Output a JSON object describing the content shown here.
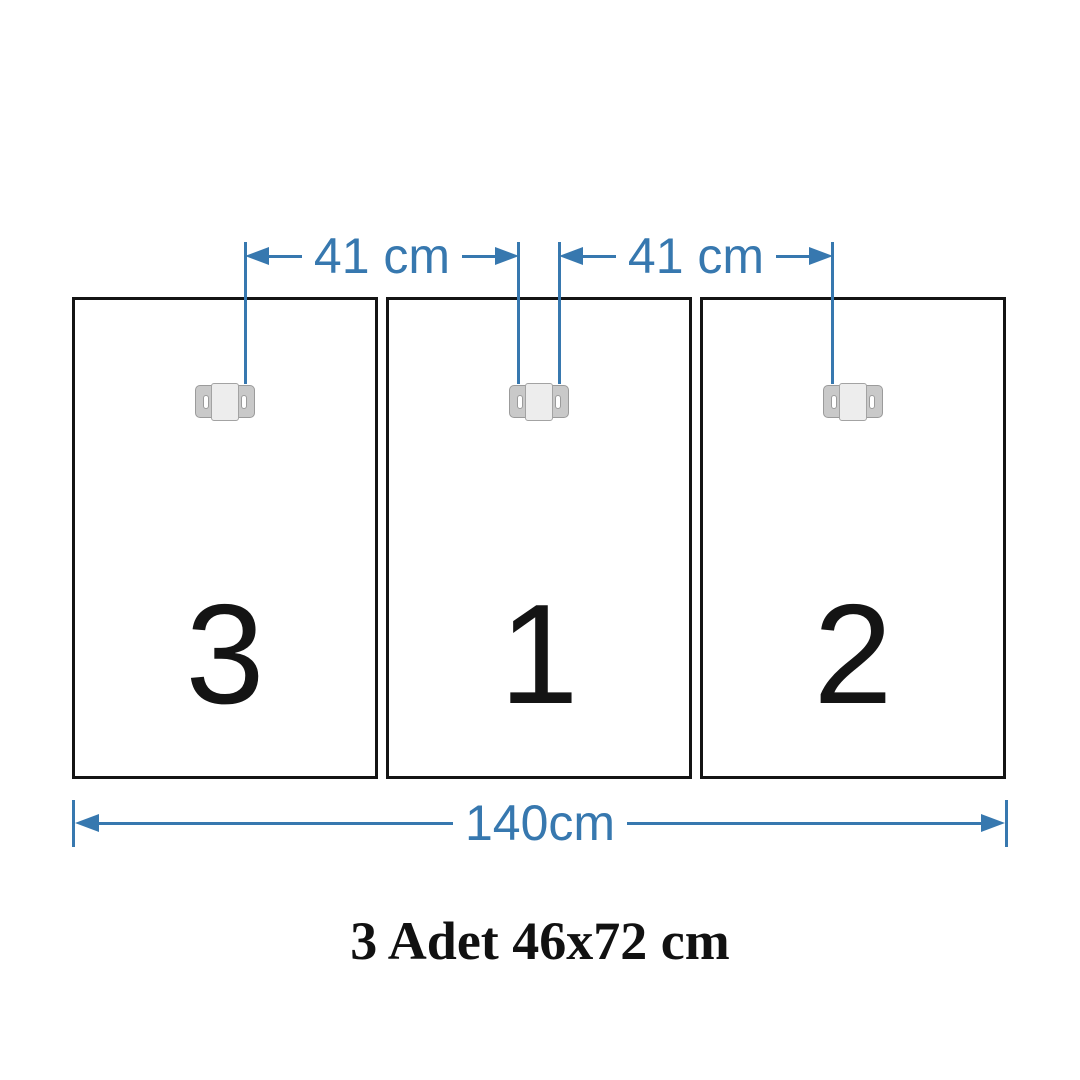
{
  "diagram": {
    "caption": "3 Adet 46x72 cm",
    "panels": [
      {
        "id": "left",
        "label": "3"
      },
      {
        "id": "center",
        "label": "1"
      },
      {
        "id": "right",
        "label": "2"
      }
    ],
    "dimensions": [
      {
        "id": "top-left",
        "label": "41 cm"
      },
      {
        "id": "top-right",
        "label": "41 cm"
      },
      {
        "id": "bottom",
        "label": "140cm"
      }
    ],
    "colors": {
      "dimension_blue": "#3778af",
      "panel_border": "#141414",
      "text_black": "#141414",
      "bracket_ear": "#c9c9c9",
      "bracket_center": "#ededed",
      "bracket_border": "#9b9b9b"
    }
  }
}
